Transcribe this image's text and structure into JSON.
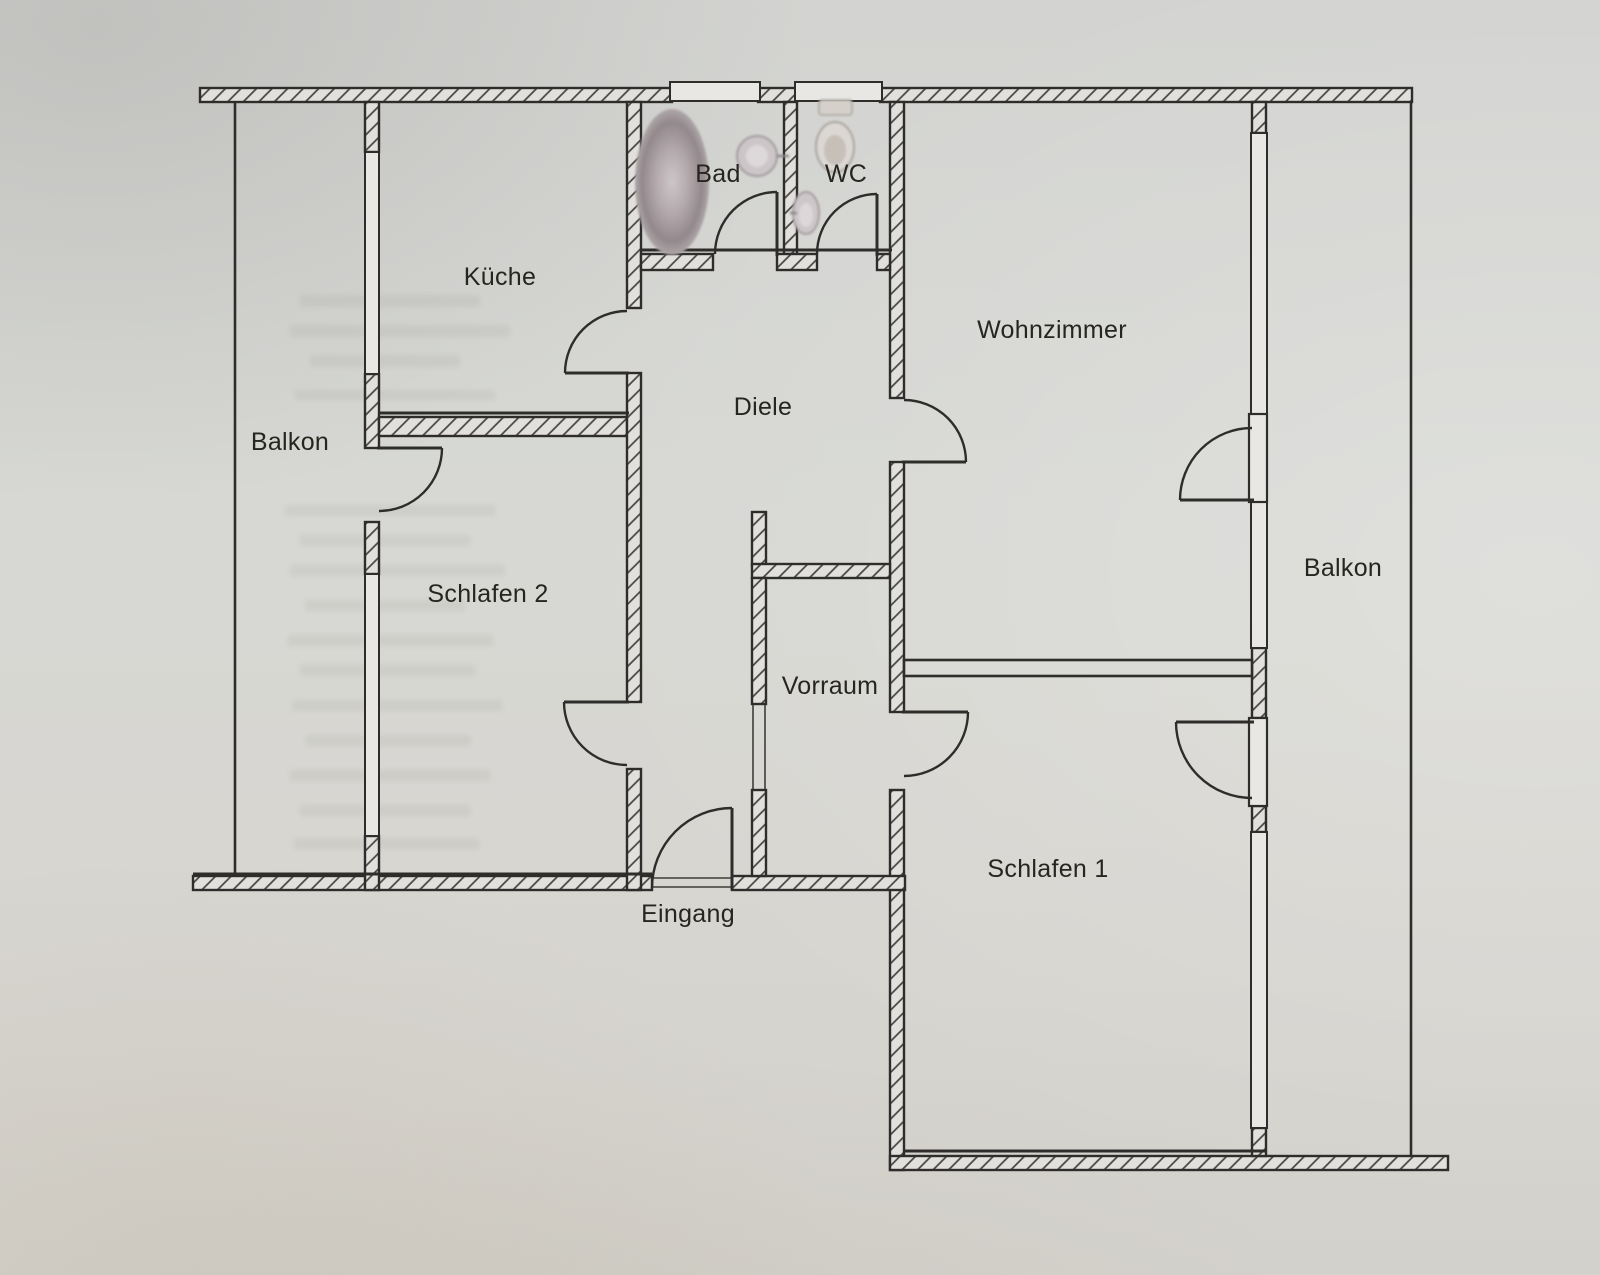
{
  "document": {
    "type": "apartment-floor-plan",
    "language": "de",
    "style": "scanned paper plan, hatched walls"
  },
  "colors": {
    "paper": "#d6d7d3",
    "line": "#2e2d2b",
    "hatch_line": "#45433f",
    "wall_fill": "#e1e0dc",
    "fixture_gray": "#b3a9ac",
    "label_text": "#26251f"
  },
  "rooms": [
    {
      "id": "balkon-left",
      "label": "Balkon",
      "position": "far left strip"
    },
    {
      "id": "kueche",
      "label": "Küche",
      "position": "top left"
    },
    {
      "id": "bad",
      "label": "Bad",
      "position": "top middle"
    },
    {
      "id": "wc",
      "label": "WC",
      "position": "top middle right"
    },
    {
      "id": "wohnzimmer",
      "label": "Wohnzimmer",
      "position": "top right"
    },
    {
      "id": "diele",
      "label": "Diele",
      "position": "center hallway"
    },
    {
      "id": "schlafen2",
      "label": "Schlafen 2",
      "position": "left middle"
    },
    {
      "id": "vorraum",
      "label": "Vorraum",
      "position": "center lower"
    },
    {
      "id": "balkon-right",
      "label": "Balkon",
      "position": "right strip"
    },
    {
      "id": "schlafen1",
      "label": "Schlafen 1",
      "position": "bottom right"
    },
    {
      "id": "eingang",
      "label": "Eingang",
      "position": "bottom center, outside wall"
    }
  ],
  "doors": [
    {
      "from": "Diele",
      "to": "Küche",
      "swing": "into kitchen"
    },
    {
      "from": "Diele",
      "to": "Bad",
      "swing": "into bathroom"
    },
    {
      "from": "Diele",
      "to": "WC",
      "swing": "into wc"
    },
    {
      "from": "Diele",
      "to": "Wohnzimmer",
      "swing": "into living room"
    },
    {
      "from": "Diele",
      "to": "Schlafen 2",
      "swing": "into bedroom 2"
    },
    {
      "from": "Diele",
      "to": "Vorraum",
      "swing": "open passage, no leaf"
    },
    {
      "from": "Vorraum",
      "to": "Schlafen 1",
      "swing": "into bedroom 1"
    },
    {
      "from": "Schlafen 2",
      "to": "Balkon",
      "swing": "into bedroom 2"
    },
    {
      "from": "Wohnzimmer",
      "to": "Balkon",
      "swing": "into living room"
    },
    {
      "from": "Schlafen 1",
      "to": "Balkon",
      "swing": "into bedroom 1"
    },
    {
      "from": "außen",
      "to": "Eingang",
      "swing": "into hallway"
    }
  ],
  "windows": [
    {
      "room": "Küche",
      "wall": "west"
    },
    {
      "room": "Schlafen 2",
      "wall": "west"
    },
    {
      "room": "Bad",
      "wall": "north"
    },
    {
      "room": "WC",
      "wall": "north"
    },
    {
      "room": "Wohnzimmer",
      "wall": "east",
      "count": 2
    },
    {
      "room": "Schlafen 1",
      "wall": "east"
    }
  ],
  "fixtures": [
    {
      "id": "bathtub",
      "room": "Bad"
    },
    {
      "id": "washbasin",
      "room": "Bad"
    },
    {
      "id": "toilet",
      "room": "WC"
    },
    {
      "id": "hand-basin",
      "room": "WC"
    }
  ]
}
